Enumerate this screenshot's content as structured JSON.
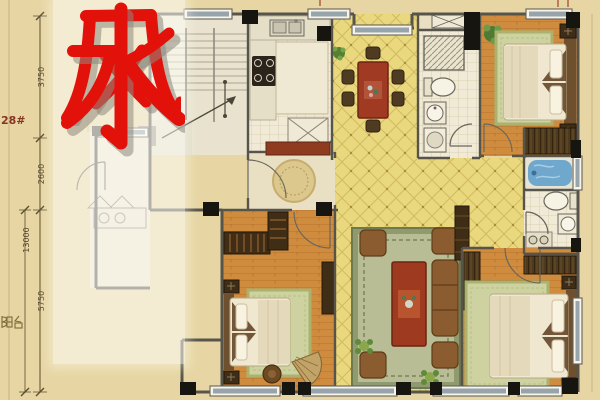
{
  "overlay": {
    "characters": {
      "first": "风",
      "second": "水"
    },
    "color": "#e2120b",
    "panel_color": "rgba(255,255,250,0.55)"
  },
  "dimensions": {
    "segment_top": "3750",
    "segment_middle": "2600",
    "segment_bottom": "5750",
    "overall": "13000"
  },
  "labels": {
    "building_number": "28#",
    "balcony": "阳台"
  },
  "colors": {
    "background": "#e7d6a3",
    "tile_yellow": "#e9d87e",
    "wood_floor": "#cf8c3e",
    "furniture_red": "#9e3a20",
    "wall_dark": "#57544b",
    "bathtub_blue": "#6fa8cc",
    "rug_green": "#cdd2a0",
    "accent_red": "#e2120b"
  }
}
